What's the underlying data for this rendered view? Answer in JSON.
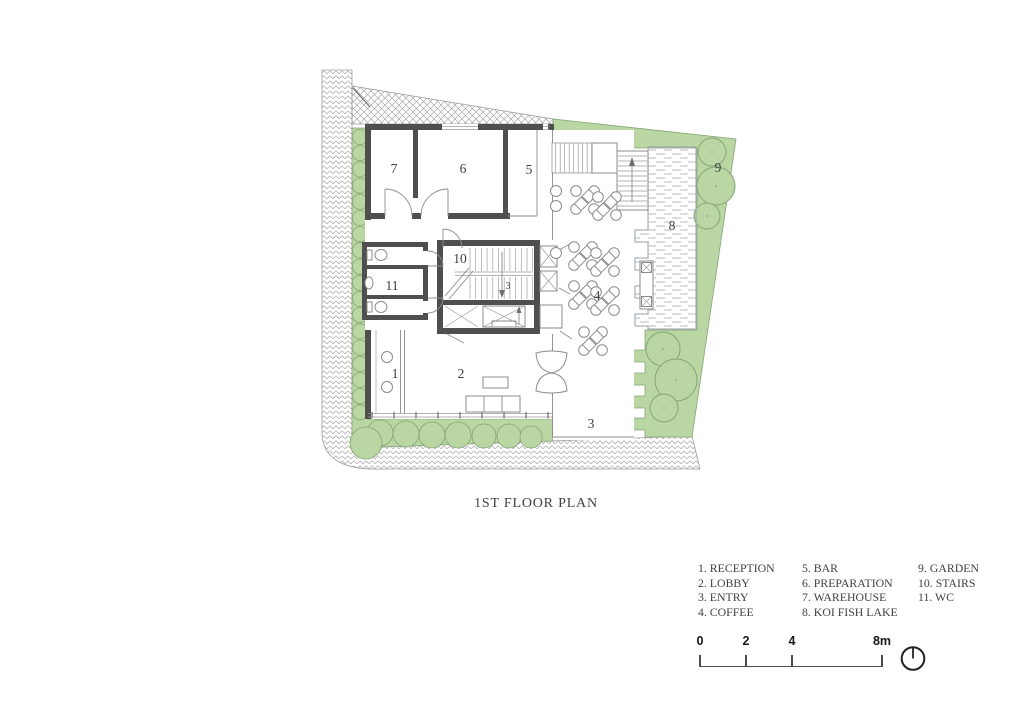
{
  "window": {
    "width": 1024,
    "height": 724,
    "background": "#ffffff"
  },
  "title": {
    "text": "1ST FLOOR PLAN"
  },
  "plan": {
    "room_labels": [
      {
        "num": "1",
        "room": "reception",
        "x": 395,
        "y": 378
      },
      {
        "num": "2",
        "room": "lobby",
        "x": 461,
        "y": 378
      },
      {
        "num": "3",
        "room": "entry",
        "x": 591,
        "y": 428
      },
      {
        "num": "4",
        "room": "coffee",
        "x": 597,
        "y": 300
      },
      {
        "num": "5",
        "room": "bar",
        "x": 529,
        "y": 174
      },
      {
        "num": "6",
        "room": "preparation",
        "x": 463,
        "y": 173
      },
      {
        "num": "7",
        "room": "warehouse",
        "x": 394,
        "y": 173
      },
      {
        "num": "8",
        "room": "koi-fish-lake",
        "x": 672,
        "y": 230
      },
      {
        "num": "9",
        "room": "garden",
        "x": 718,
        "y": 172
      },
      {
        "num": "10",
        "room": "stairs",
        "x": 460,
        "y": 263
      },
      {
        "num": "11",
        "room": "wc",
        "x": 392,
        "y": 290
      }
    ],
    "stair_direction_note": "3",
    "colors": {
      "garden": "#b9d6a3",
      "tree": "#86a577",
      "wall": "#4f4f4f",
      "line": "#8b8b8b",
      "hatch": "#a8a8a8",
      "water": "#9aa3ab",
      "ink": "#3f3f46"
    }
  },
  "legend": {
    "columns": [
      {
        "items": [
          "1. RECEPTION",
          "2. LOBBY",
          "3. ENTRY",
          "4. COFFEE"
        ]
      },
      {
        "items": [
          "5. BAR",
          "6. PREPARATION",
          "7. WAREHOUSE",
          "8. KOI FISH LAKE"
        ]
      },
      {
        "items": [
          "9. GARDEN",
          "10. STAIRS",
          "11. WC"
        ]
      }
    ]
  },
  "scale_bar": {
    "ticks": [
      {
        "label": "0",
        "x": 700
      },
      {
        "label": "2",
        "x": 746
      },
      {
        "label": "4",
        "x": 792
      },
      {
        "label": "8m",
        "x": 882
      }
    ],
    "bar": {
      "x1": 700,
      "x2": 882
    }
  },
  "compass": {
    "icon": "north-arrow"
  }
}
